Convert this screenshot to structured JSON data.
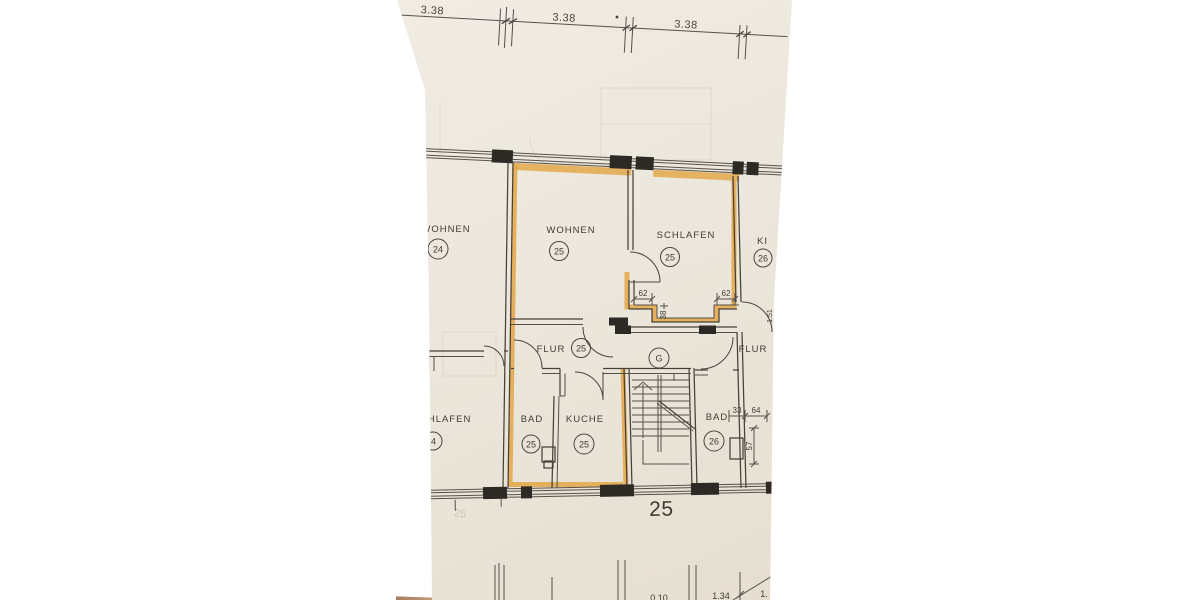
{
  "plan": {
    "top_dimensions": [
      "3.38",
      "3.38",
      "3.38"
    ],
    "house_number": "25",
    "ghost_number": "25",
    "stairwell_label": "G",
    "rooms": {
      "wohnen_24": {
        "name": "WOHNEN",
        "number": "24"
      },
      "wohnen_25": {
        "name": "WOHNEN",
        "number": "25"
      },
      "schlafen_25": {
        "name": "SCHLAFEN",
        "number": "25"
      },
      "kind_26": {
        "name": "KI",
        "number": "26"
      },
      "flur_25": {
        "name": "FLUR",
        "number": "25"
      },
      "bad_25": {
        "name": "BAD",
        "number": "25"
      },
      "kueche_25": {
        "name": "KUCHE",
        "number": "25"
      },
      "schlafen_left": {
        "name": "SCHLAFEN",
        "number": "24"
      },
      "flur_right": {
        "name": "FLUR"
      },
      "bad_26": {
        "name": "BAD",
        "number": "26"
      }
    },
    "niche_dimensions": {
      "left": "62",
      "right": "62",
      "depth": "38"
    },
    "bad26_dimensions": {
      "width_a": "33",
      "width_b": "64",
      "height": "57"
    },
    "door_dimension": "1.51",
    "bottom_dimensions": {
      "partial_left": "0.10",
      "value": "1.34",
      "partial_right": "1."
    },
    "colors": {
      "paper": "#ece7dd",
      "line": "#46413b",
      "highlight": "#e2a84b"
    }
  }
}
